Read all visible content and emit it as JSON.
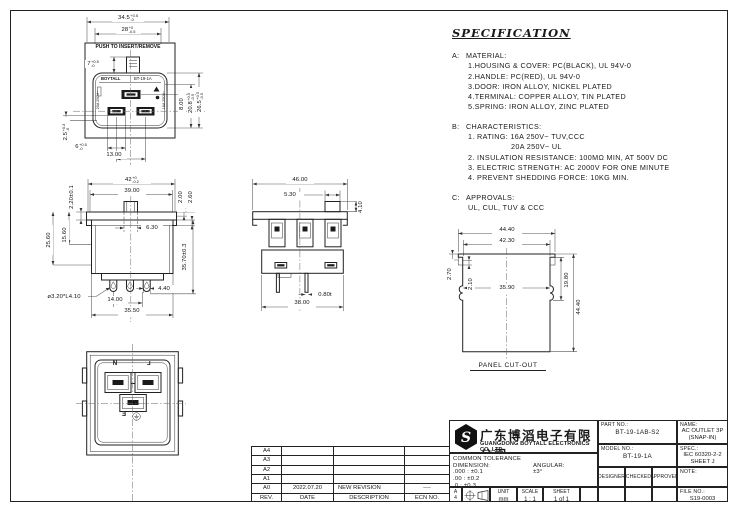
{
  "spec": {
    "title": "SPECIFICATION",
    "sections": [
      {
        "label": "A:",
        "heading": "MATERIAL:",
        "lines": [
          "1.HOUSING & COVER: PC(BLACK), UL 94V-0",
          "2.HANDLE: PC(RED), UL 94V-0",
          "3.DOOR: IRON ALLOY, NICKEL PLATED",
          "4.TERMINAL: COPPER ALLOY, TIN PLATED",
          "5.SPRING: IRON ALLOY, ZINC PLATED"
        ]
      },
      {
        "label": "B:",
        "heading": "CHARACTERISTICS:",
        "lines": [
          "1. RATING: 16A 250V~ TUV,CCC",
          "20A 250V~ UL",
          "2. INSULATION RESISTANCE: 100MΩ MIN, AT 500V DC",
          "3. ELECTRIC STRENGTH: AC 2000V FOR ONE MINUTE",
          "4. PREVENT SHEDDING FORCE: 10KG MIN."
        ]
      },
      {
        "label": "C:",
        "heading": "APPROVALS:",
        "lines": [
          "UL, CUL, TUV & CCC"
        ]
      }
    ]
  },
  "views": {
    "face": {
      "texts": {
        "push": "PUSH TO INSERT/REMOVE",
        "brand": "BOYTALL",
        "model": "BT-19-1A",
        "rating_left": "20A 250V~",
        "rating_right": "16A 250V~"
      },
      "dims": {
        "w_outer": {
          "m": "34.5",
          "sup": "+0.5",
          "sub": "-0"
        },
        "w_inner": {
          "m": "28",
          "sup": "+0",
          "sub": "-0.5"
        },
        "handle_h": {
          "m": "7",
          "sup": "+0.5",
          "sub": "-0"
        },
        "slot_offset": {
          "m": "8.00"
        },
        "opening_h": {
          "m": "20.8",
          "sup": "+0.5",
          "sub": "-0.5"
        },
        "face_h": {
          "m": "26.5",
          "sup": "+0.5",
          "sub": "-0.5"
        },
        "edge_gap": {
          "m": "2.5",
          "sup": "+0.3",
          "sub": "-0"
        },
        "slot_w": {
          "m": "6",
          "sup": "+0.5",
          "sub": "-0"
        },
        "slot_pitch": {
          "m": "13.00"
        }
      }
    },
    "side": {
      "dims": {
        "top_w": {
          "m": "42",
          "sup": "+0",
          "sub": "-0.2"
        },
        "flange_w": {
          "m": "39.00"
        },
        "flange_t": {
          "m": "2.20±0.1"
        },
        "lip_a": {
          "m": "2.00"
        },
        "lip_b": {
          "m": "2.60"
        },
        "h_upper": {
          "m": "15.60"
        },
        "h_mid": {
          "m": "25.60"
        },
        "tab_w": {
          "m": "6.30"
        },
        "body_h": {
          "m": "35.70±0.3"
        },
        "pin": {
          "m": "ø3.20*L4.10"
        },
        "pin_w": {
          "m": "4.40"
        },
        "pin_pitch": {
          "m": "14.00"
        },
        "body_w": {
          "m": "35.50"
        }
      }
    },
    "bottom": {
      "dims": {
        "top_w": {
          "m": "46.00"
        },
        "tab_w": {
          "m": "5.30"
        },
        "tab_h": {
          "m": "4.10"
        },
        "term_t": {
          "m": "0.80t"
        },
        "body_w": {
          "m": "38.00"
        }
      }
    },
    "panel": {
      "caption": "PANEL CUT-OUT",
      "dims": {
        "w_outer": {
          "m": "44.40"
        },
        "w_inner": {
          "m": "42.30"
        },
        "notch": {
          "m": "2.70"
        },
        "latch": {
          "m": "2.10"
        },
        "inner_w": {
          "m": "35.90"
        },
        "latch_h": {
          "m": "19.80"
        },
        "height": {
          "m": "44.40"
        }
      }
    },
    "rear": {
      "labels": {
        "n": "N",
        "l": "L",
        "e": "E"
      }
    }
  },
  "revision_table": {
    "headers": [
      "REV.",
      "DATE",
      "DESCRIPTION",
      "ECN NO."
    ],
    "rows": [
      {
        "rev": "A4",
        "date": "",
        "description": "",
        "ecn": ""
      },
      {
        "rev": "A3",
        "date": "",
        "description": "",
        "ecn": ""
      },
      {
        "rev": "A2",
        "date": "",
        "description": "",
        "ecn": ""
      },
      {
        "rev": "A1",
        "date": "",
        "description": "",
        "ecn": ""
      },
      {
        "rev": "A0",
        "date": "2022.07.20",
        "description": "NEW REVISION",
        "ecn": "----"
      }
    ]
  },
  "title_block": {
    "company": {
      "name_zh": "广东博滔电子有限公司",
      "name_en": "GUANGDONG BOYTALL ELECTRONICS CO.,LTD"
    },
    "tolerance": {
      "title": "COMMON TOLERANCE",
      "dimension_label": "DIMENSION:",
      "angular_label": "ANGULAR:",
      "dim_rows": [
        ".000 : ±0.1",
        ".00 : ±0.2",
        ".0 : ±0.3"
      ],
      "angular_value": "±3°"
    },
    "part_no": {
      "label": "PART NO.:",
      "value": "BT-19-1AB-S2"
    },
    "name": {
      "label": "NAME:",
      "line1": "AC OUTLET 3P",
      "line2": "(SNAP-IN)"
    },
    "model_no": {
      "label": "MODEL NO.:",
      "value": "BT-19-1A"
    },
    "spec": {
      "label": "SPEC.:",
      "line1": "IEC 60320-2-2",
      "line2": "SHEET J"
    },
    "signoff": {
      "designer": "DESIGNER",
      "checked": "CHECKED",
      "approved": "APPROVED"
    },
    "note_label": "NOTE:",
    "file_no": {
      "label": "FILE NO.:",
      "value": "S19-0003"
    },
    "paper": {
      "row1": "A",
      "row2": "4"
    },
    "unit": {
      "label": "UNIT",
      "value": "mm"
    },
    "scale": {
      "label": "SCALE",
      "value": "1 : 1"
    },
    "sheet": {
      "label": "SHEET",
      "value": "1 of 1"
    }
  }
}
